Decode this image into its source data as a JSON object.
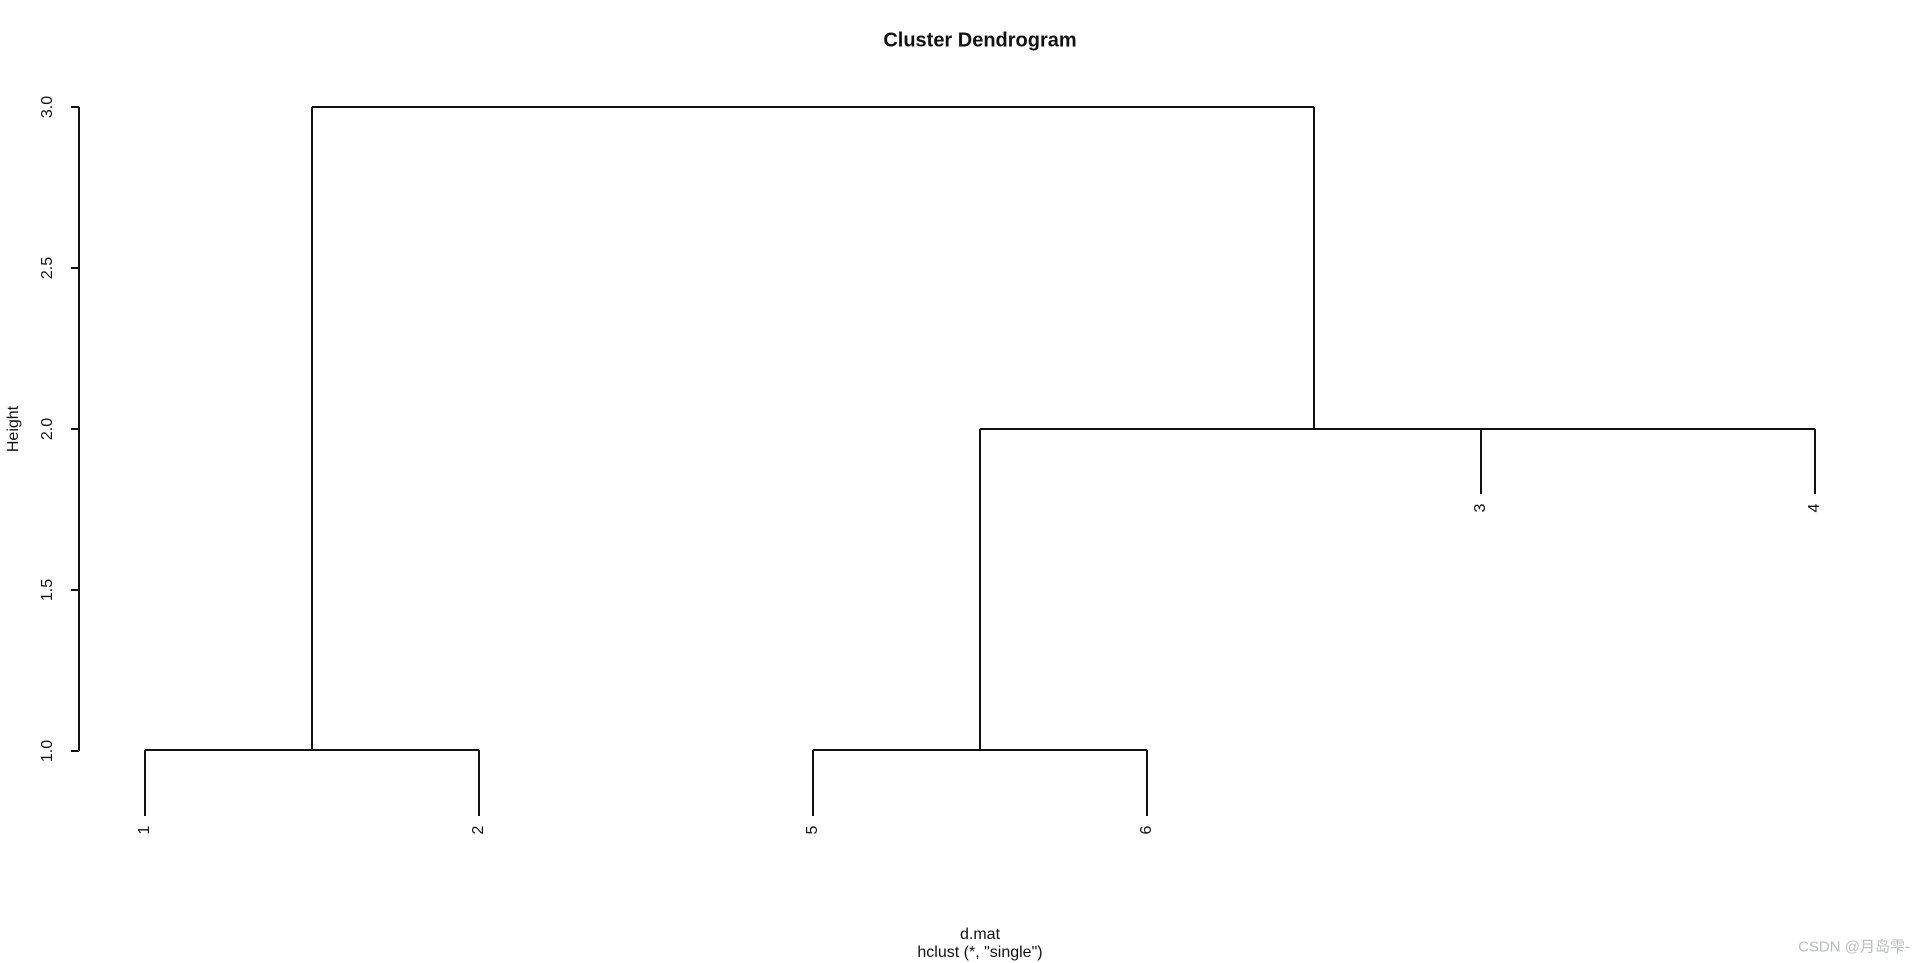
{
  "title": "Cluster Dendrogram",
  "y_axis": {
    "label": "Height",
    "tick_labels": [
      {
        "text": "3.0",
        "x": 48,
        "y": 107
      },
      {
        "text": "2.5",
        "x": 48,
        "y": 268
      },
      {
        "text": "2.0",
        "x": 48,
        "y": 429
      },
      {
        "text": "1.5",
        "x": 48,
        "y": 590
      },
      {
        "text": "1.0",
        "x": 48,
        "y": 751
      }
    ]
  },
  "x_label": {
    "line1": "d.mat",
    "line2": "hclust (*, \"single\")"
  },
  "watermark": "CSDN @月岛雫-",
  "chart_data": {
    "type": "dendrogram",
    "title": "Cluster Dendrogram",
    "ylabel": "Height",
    "xlabel": "d.mat",
    "subtitle": "hclust (*, \"single\")",
    "clustering_method": "single",
    "data_name": "d.mat",
    "leaf_order": [
      "1",
      "2",
      "5",
      "6",
      "3",
      "4"
    ],
    "y_ticks": [
      1.0,
      1.5,
      2.0,
      2.5,
      3.0
    ],
    "ylim": [
      1.0,
      3.0
    ],
    "merges": [
      {
        "members": [
          "1",
          "2"
        ],
        "height": 1.0
      },
      {
        "members": [
          "5",
          "6"
        ],
        "height": 1.0
      },
      {
        "members": [
          "3",
          "4"
        ],
        "height": 2.0
      },
      {
        "members": [
          [
            "5",
            "6"
          ],
          [
            "3",
            "4"
          ]
        ],
        "height": 2.0
      },
      {
        "members": [
          [
            "1",
            "2"
          ],
          [
            "5",
            "6",
            "3",
            "4"
          ]
        ],
        "height": 3.0
      }
    ],
    "grid": false,
    "legend": false
  },
  "geometry": {
    "stroke": "#111111",
    "line_width": 2,
    "segments": [
      {
        "x1": 312,
        "y1": 107,
        "x2": 1314,
        "y2": 107
      },
      {
        "x1": 312,
        "y1": 107,
        "x2": 312,
        "y2": 750
      },
      {
        "x1": 1314,
        "y1": 107,
        "x2": 1314,
        "y2": 429
      },
      {
        "x1": 980,
        "y1": 429,
        "x2": 1815,
        "y2": 429
      },
      {
        "x1": 980,
        "y1": 429,
        "x2": 980,
        "y2": 750
      },
      {
        "x1": 1481,
        "y1": 429,
        "x2": 1481,
        "y2": 494
      },
      {
        "x1": 1815,
        "y1": 429,
        "x2": 1815,
        "y2": 494
      },
      {
        "x1": 145,
        "y1": 750,
        "x2": 479,
        "y2": 750
      },
      {
        "x1": 145,
        "y1": 750,
        "x2": 145,
        "y2": 816
      },
      {
        "x1": 479,
        "y1": 750,
        "x2": 479,
        "y2": 816
      },
      {
        "x1": 813,
        "y1": 750,
        "x2": 1147,
        "y2": 750
      },
      {
        "x1": 813,
        "y1": 750,
        "x2": 813,
        "y2": 816
      },
      {
        "x1": 1147,
        "y1": 750,
        "x2": 1147,
        "y2": 816
      },
      {
        "x1": 79,
        "y1": 107,
        "x2": 79,
        "y2": 751
      },
      {
        "x1": 71,
        "y1": 107,
        "x2": 79,
        "y2": 107
      },
      {
        "x1": 71,
        "y1": 268,
        "x2": 79,
        "y2": 268
      },
      {
        "x1": 71,
        "y1": 429,
        "x2": 79,
        "y2": 429
      },
      {
        "x1": 71,
        "y1": 590,
        "x2": 79,
        "y2": 590
      },
      {
        "x1": 71,
        "y1": 751,
        "x2": 79,
        "y2": 751
      }
    ],
    "leaf_labels": [
      {
        "text": "1",
        "x": 145,
        "y": 830
      },
      {
        "text": "2",
        "x": 479,
        "y": 830
      },
      {
        "text": "5",
        "x": 813,
        "y": 830
      },
      {
        "text": "6",
        "x": 1147,
        "y": 830
      },
      {
        "text": "3",
        "x": 1481,
        "y": 508
      },
      {
        "text": "4",
        "x": 1815,
        "y": 508
      }
    ],
    "title_pos": {
      "x": 980,
      "y": 41
    },
    "ylab_pos": {
      "x": 14,
      "y": 429
    },
    "xlab1_pos": {
      "x": 980,
      "y": 935
    },
    "xlab2_pos": {
      "x": 980,
      "y": 953
    },
    "watermark_pos": {
      "y": 946
    }
  }
}
